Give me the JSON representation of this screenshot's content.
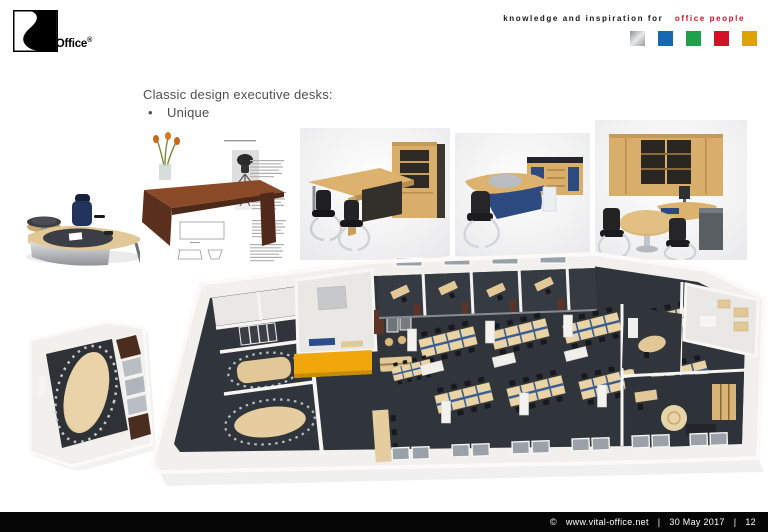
{
  "header": {
    "logo_text": "Vital-Office",
    "registered": "®",
    "tagline_black": "knowledge and inspiration for",
    "tagline_red": "office people",
    "brand_squares": [
      {
        "name": "silver",
        "color": "#c0c0c0"
      },
      {
        "name": "blue",
        "color": "#1668b1"
      },
      {
        "name": "green",
        "color": "#1fa04b"
      },
      {
        "name": "red",
        "color": "#d50f26"
      },
      {
        "name": "gold",
        "color": "#dfa301"
      }
    ]
  },
  "content": {
    "title": "Classic design executive desks:",
    "bullet": "•",
    "bullets": [
      "Unique"
    ]
  },
  "images": {
    "exec_desk_alt": "Executive desk with curved silver front, dark oval top inlay and blue chair",
    "catalog_page_alt": "Catalogue page with wooden desk, flower vase, chair photos and text",
    "beech_desk_cabinet_alt": "Beech executive desk with black chairs and tall cabinet",
    "blue_desk_sideboard_alt": "Beech desk with blue front panels, chair and sideboard",
    "office_set_alt": "Office set with cabinet wall, desk and round meeting table",
    "conference_room_alt": "3D cutaway of conference room with oval table",
    "floor_plan_alt": "3D office floor plan with meeting rooms, open plan desks and offices"
  },
  "palette": {
    "accent_orange": "#F0A70C",
    "panel_blue": "#2C4A80",
    "desk_beige": "#E3C897",
    "floor_charcoal": "#30343B"
  },
  "footer": {
    "copyright": "©",
    "site": "www.vital-office.net",
    "sep": "|",
    "date": "30 May 2017",
    "page": "12"
  }
}
